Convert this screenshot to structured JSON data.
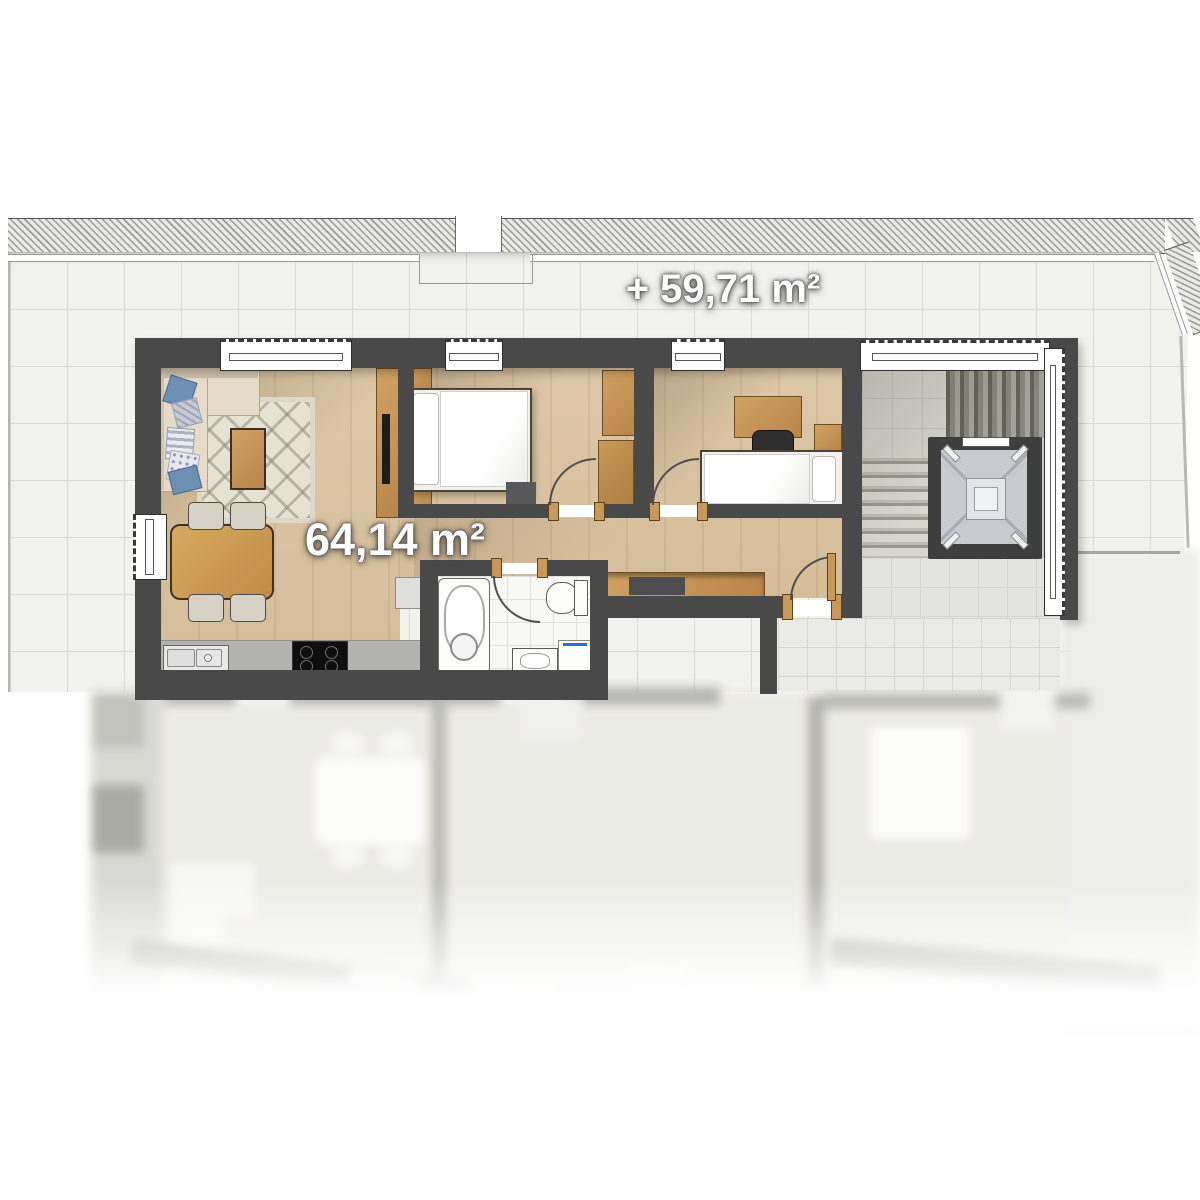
{
  "title": "apartment-floor-plan",
  "labels": {
    "terrace_area": "+ 59,71 m²",
    "apartment_area": "64,14 m²"
  },
  "palette": {
    "wall": "#494949",
    "wood_floor": "#d9c3a2",
    "terrace_tile": "#f2f2ef",
    "landing_tile": "#eaeae7",
    "bath_tile": "#f8f8f6",
    "furniture_wood": "#c9995c",
    "sofa_fabric": "#e6dbc8",
    "pillow_blue": "#6f8fb5",
    "stair_tread": "#8e8e84",
    "elevator_cab": "#c8cbcf",
    "washer_accent": "#2277cc",
    "label_text": "#ffffff"
  }
}
